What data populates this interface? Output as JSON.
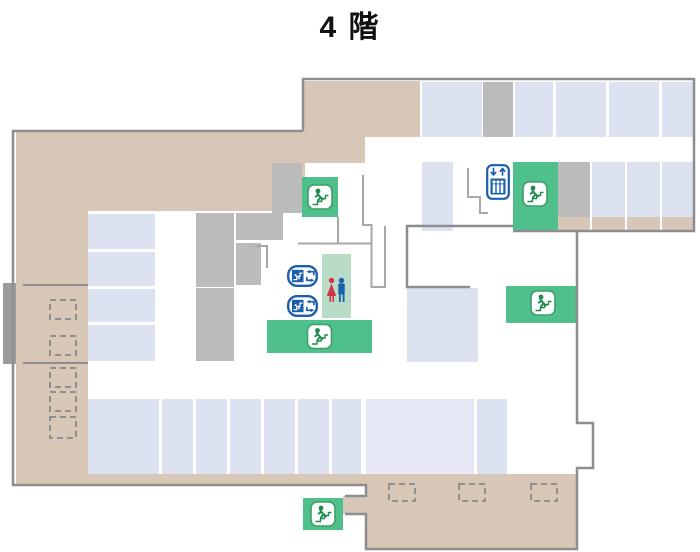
{
  "title": "4 階",
  "colors": {
    "background": "#ffffff",
    "tan": "#d8c7b7",
    "room": "#dde2f0",
    "room_light": "#e5e8f4",
    "gray_block": "#bbbbbb",
    "dark_gray": "#9b9b9b",
    "outline": "#8e8e8e",
    "wall": "#a8a8a8",
    "green": "#4fc08c",
    "pale_green": "#b9dcc7",
    "icon_green": "#1e8a4e",
    "icon_border_green": "#3da06b",
    "blue": "#1a5fae",
    "red": "#d63349"
  },
  "icons": {
    "stairs": {
      "name": "stairs-icon",
      "count": 5
    },
    "elevator": {
      "name": "elevator-icon",
      "count": 1
    },
    "escalator": {
      "name": "escalator-icon",
      "count": 2
    },
    "restroom": {
      "name": "restroom-icon",
      "female": 1,
      "male": 1
    }
  }
}
